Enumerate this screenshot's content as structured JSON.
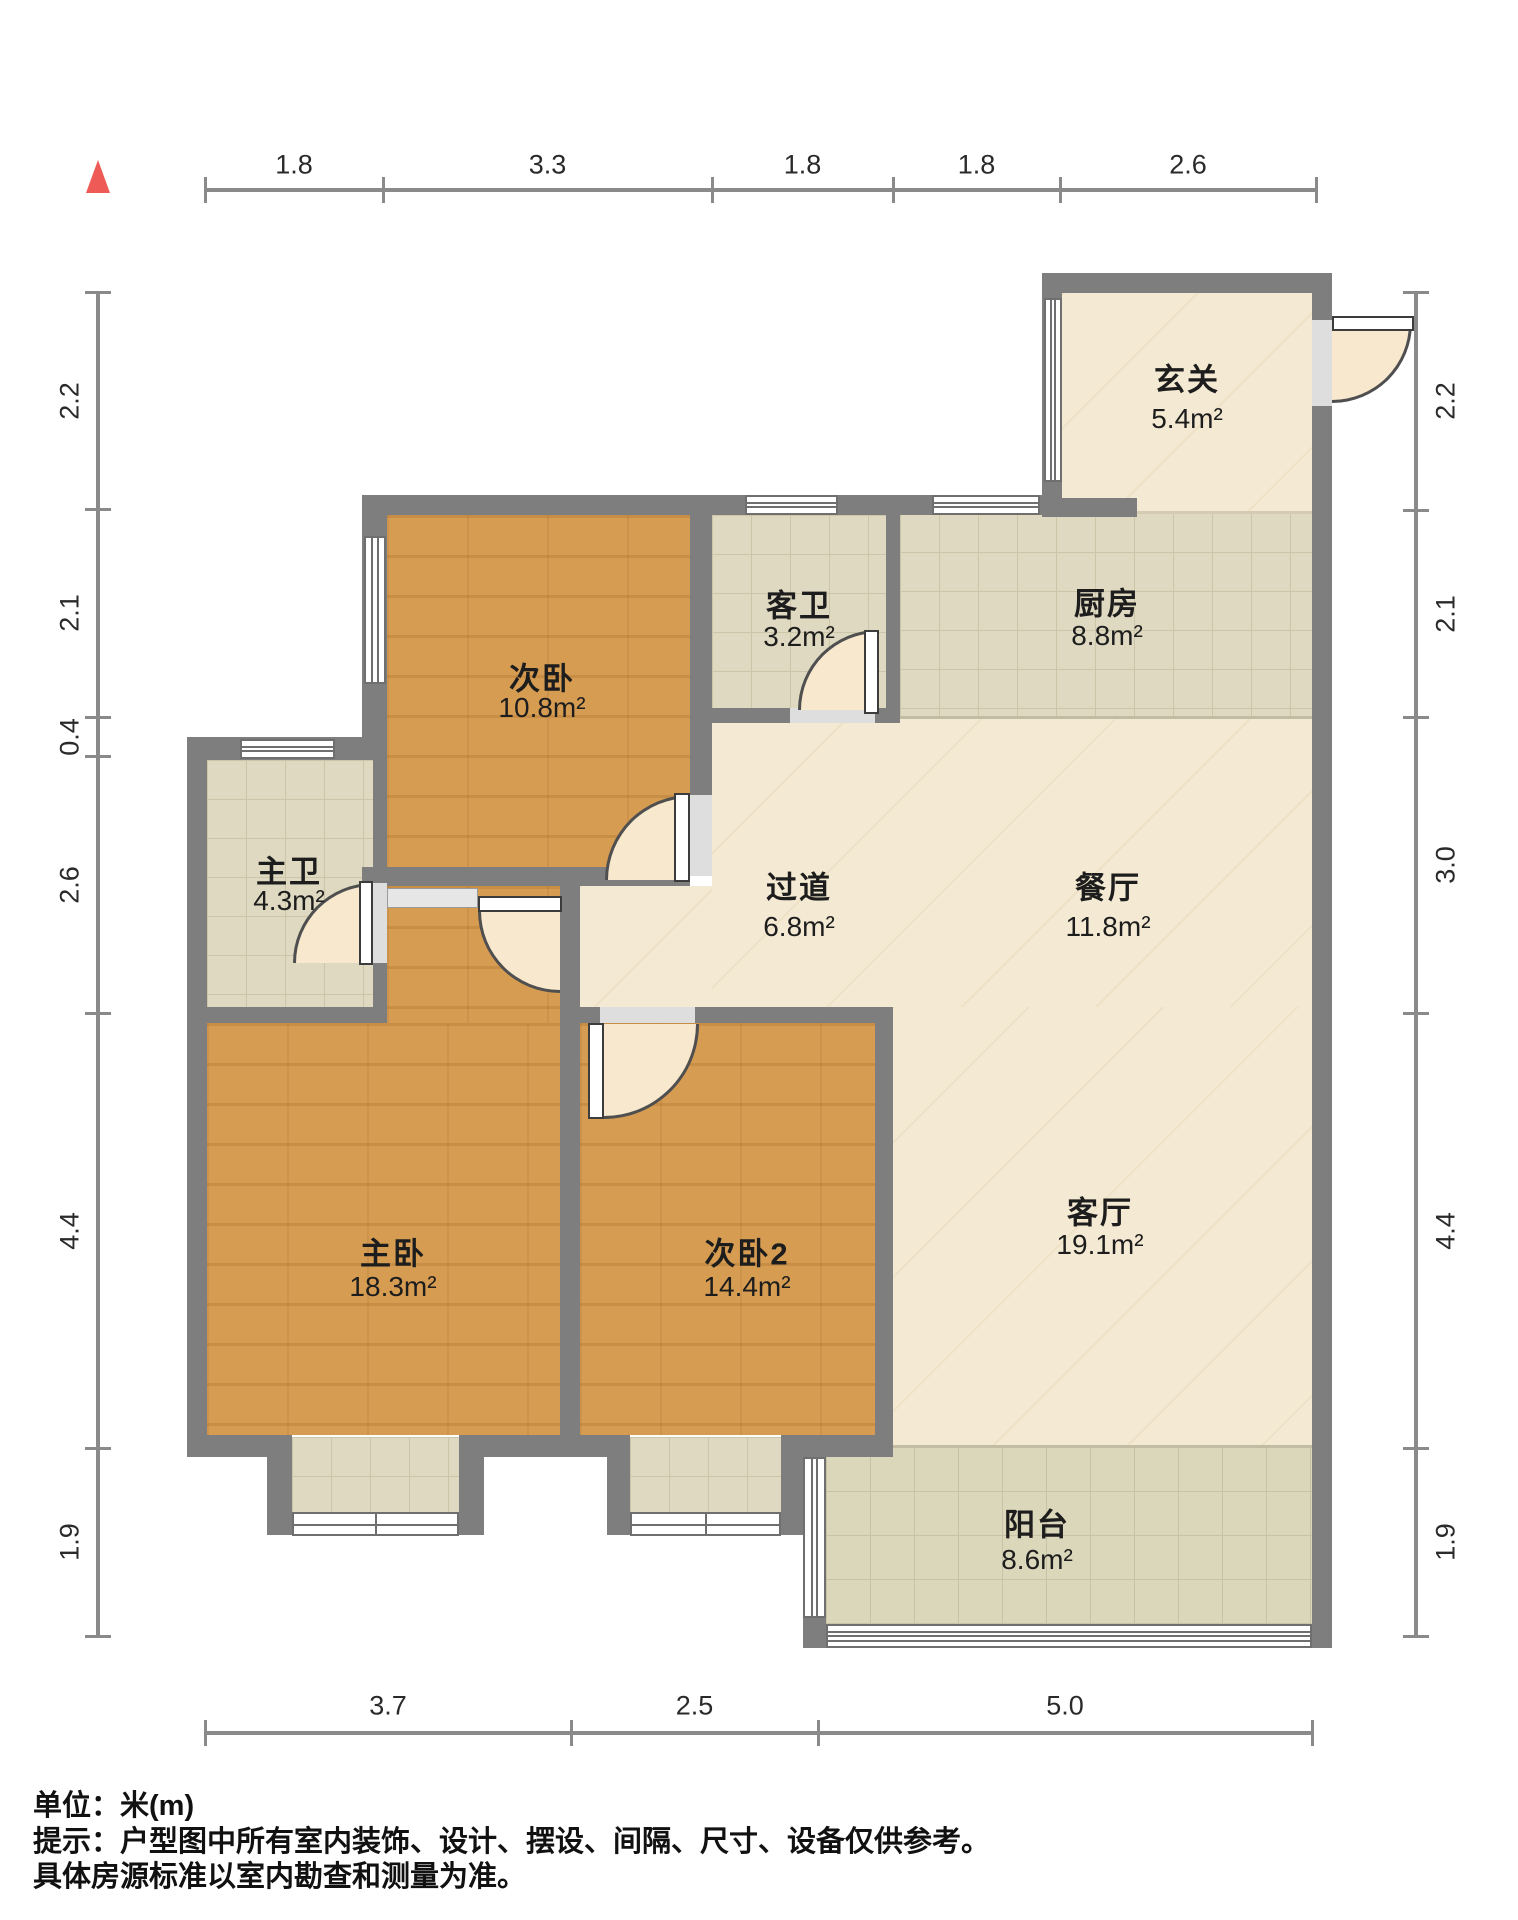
{
  "title": "户型图",
  "compass": {
    "icon": "north-triangle",
    "color": "#ee5a55"
  },
  "rooms": [
    {
      "id": "xuanguan",
      "name": "玄关",
      "area": "5.4m²"
    },
    {
      "id": "chufang",
      "name": "厨房",
      "area": "8.8m²"
    },
    {
      "id": "kewei",
      "name": "客卫",
      "area": "3.2m²"
    },
    {
      "id": "ciwo",
      "name": "次卧",
      "area": "10.8m²"
    },
    {
      "id": "zhuwei",
      "name": "主卫",
      "area": "4.3m²"
    },
    {
      "id": "guodao",
      "name": "过道",
      "area": "6.8m²"
    },
    {
      "id": "canting",
      "name": "餐厅",
      "area": "11.8m²"
    },
    {
      "id": "zhuwo",
      "name": "主卧",
      "area": "18.3m²"
    },
    {
      "id": "ciwo2",
      "name": "次卧2",
      "area": "14.4m²"
    },
    {
      "id": "keting",
      "name": "客厅",
      "area": "19.1m²"
    },
    {
      "id": "yangtai",
      "name": "阳台",
      "area": "8.6m²"
    }
  ],
  "dimensions": {
    "top": [
      "1.8",
      "3.3",
      "1.8",
      "1.8",
      "2.6"
    ],
    "bottom": [
      "3.7",
      "2.5",
      "5.0"
    ],
    "left": [
      "2.2",
      "2.1",
      "0.4",
      "2.6",
      "4.4",
      "1.9"
    ],
    "right": [
      "2.2",
      "2.1",
      "3.0",
      "4.4",
      "1.9"
    ]
  },
  "notes": {
    "unit": "单位：米(m)",
    "tip1": "提示：户型图中所有室内装饰、设计、摆设、间隔、尺寸、设备仅供参考。",
    "tip2": "具体房源标准以室内勘查和测量为准。"
  },
  "colors": {
    "wall": "#7e7e7e",
    "wood_floor": "#d69c52",
    "marble_floor": "#f4ead3",
    "tile_floor": "#ded9c0",
    "balcony_floor": "#dbd7ba",
    "door_swing": "#f8e8cd",
    "compass_red": "#ee5a55"
  }
}
